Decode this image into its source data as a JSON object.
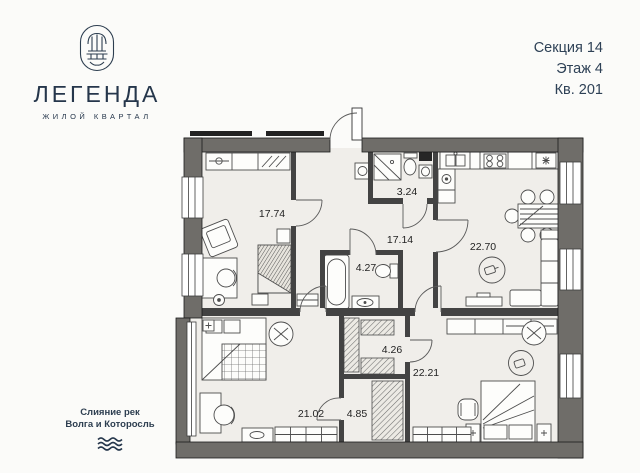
{
  "brand": {
    "name": "ЛЕГЕНДА",
    "tagline": "ЖИЛОЙ КВАРТАЛ"
  },
  "header": {
    "section": "Секция 14",
    "floor": "Этаж 4",
    "apartment": "Кв. 201"
  },
  "footer": {
    "line1": "Слияние рек",
    "line2": "Волга и Которосль"
  },
  "floorplan": {
    "rooms": [
      {
        "id": "living-17-74",
        "area": "17.74"
      },
      {
        "id": "bath-3-24",
        "area": "3.24"
      },
      {
        "id": "hall-17-14",
        "area": "17.14"
      },
      {
        "id": "kitchen-living-22-70",
        "area": "22.70"
      },
      {
        "id": "bath-4-27",
        "area": "4.27"
      },
      {
        "id": "wardrobe-4-26",
        "area": "4.26"
      },
      {
        "id": "bedroom-22-21",
        "area": "22.21"
      },
      {
        "id": "bedroom-21-02",
        "area": "21.02"
      },
      {
        "id": "corridor-4-85",
        "area": "4.85"
      }
    ]
  },
  "colors": {
    "brand_navy": "#25364b",
    "wall_grey": "#6f6d69",
    "floor_fill": "#f0eeea"
  }
}
